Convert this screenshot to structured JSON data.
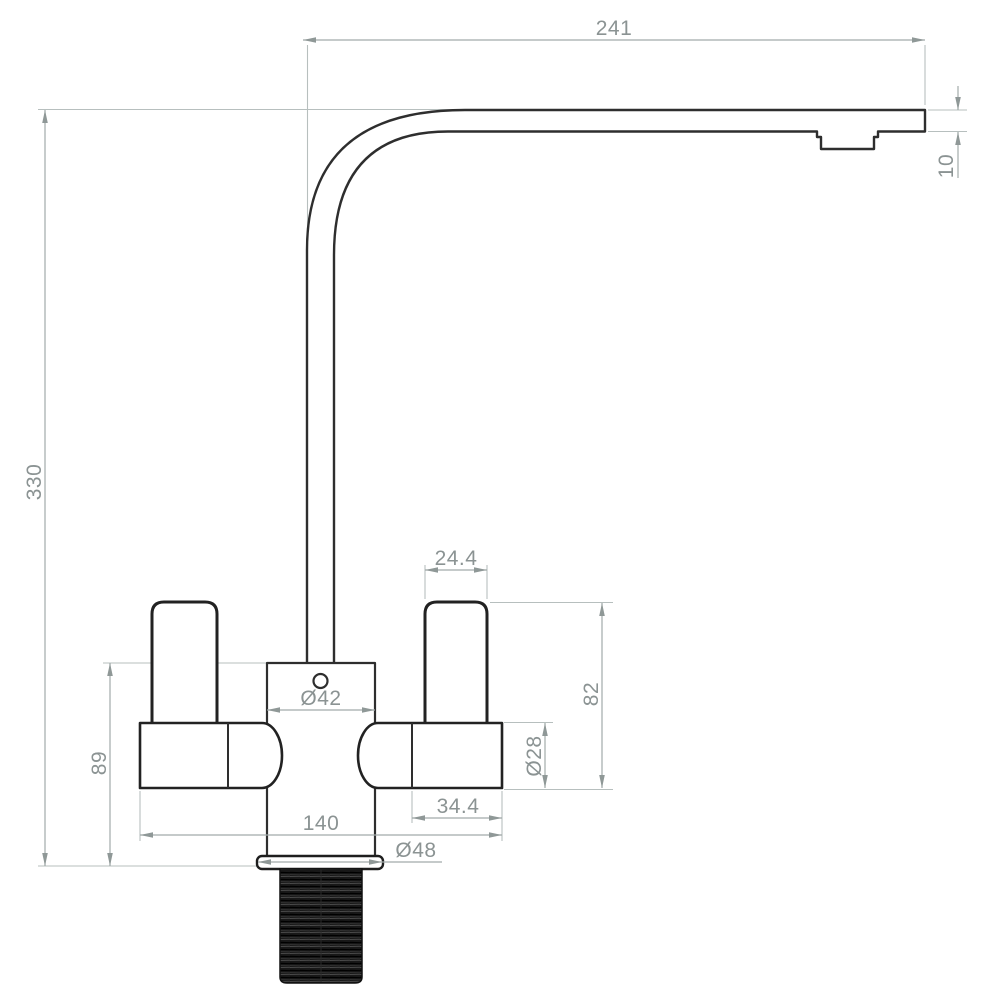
{
  "drawing": {
    "dimensions": {
      "spout_reach": "241",
      "spout_tip_height": "10",
      "overall_height": "330",
      "base_to_body_top": "89",
      "body_diameter": "Ø42",
      "handle_lever_width": "24.4",
      "handle_height": "82",
      "handle_base_diameter": "Ø28",
      "handle_base_length": "34.4",
      "handle_span": "140",
      "flange_diameter": "Ø48"
    },
    "colors": {
      "outline": "#2e2e2e",
      "dimension_line": "#a2abaa",
      "dimension_text": "#8b9393",
      "extension_line": "#b7bfbe",
      "thread_fill": "#181818",
      "background": "#ffffff"
    }
  }
}
